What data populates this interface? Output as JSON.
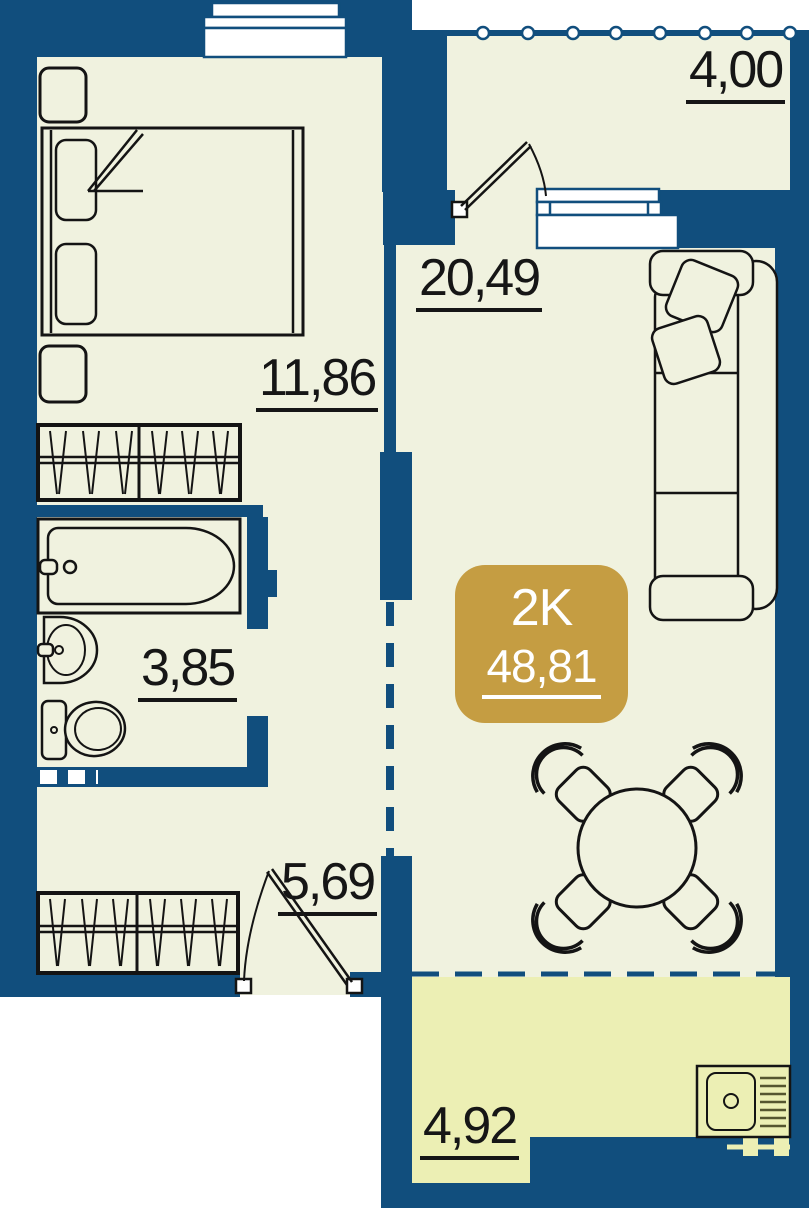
{
  "plan": {
    "title": "2-room apartment floor plan",
    "unit_badge": {
      "type": "2K",
      "area": "48,81"
    },
    "rooms": {
      "living": {
        "area": "20,49"
      },
      "bedroom": {
        "area": "11,86"
      },
      "bathroom": {
        "area": "3,85"
      },
      "hallway": {
        "area": "5,69"
      },
      "kitchen": {
        "area": "4,92"
      },
      "balcony": {
        "area": "4,00"
      }
    },
    "colors": {
      "wall": "#114E7D",
      "floor": "#F0F2DF",
      "kitchen_zone": "#ECEFB4",
      "badge": "#C59D42",
      "outline": "#141414",
      "label_text": "#161616"
    }
  }
}
